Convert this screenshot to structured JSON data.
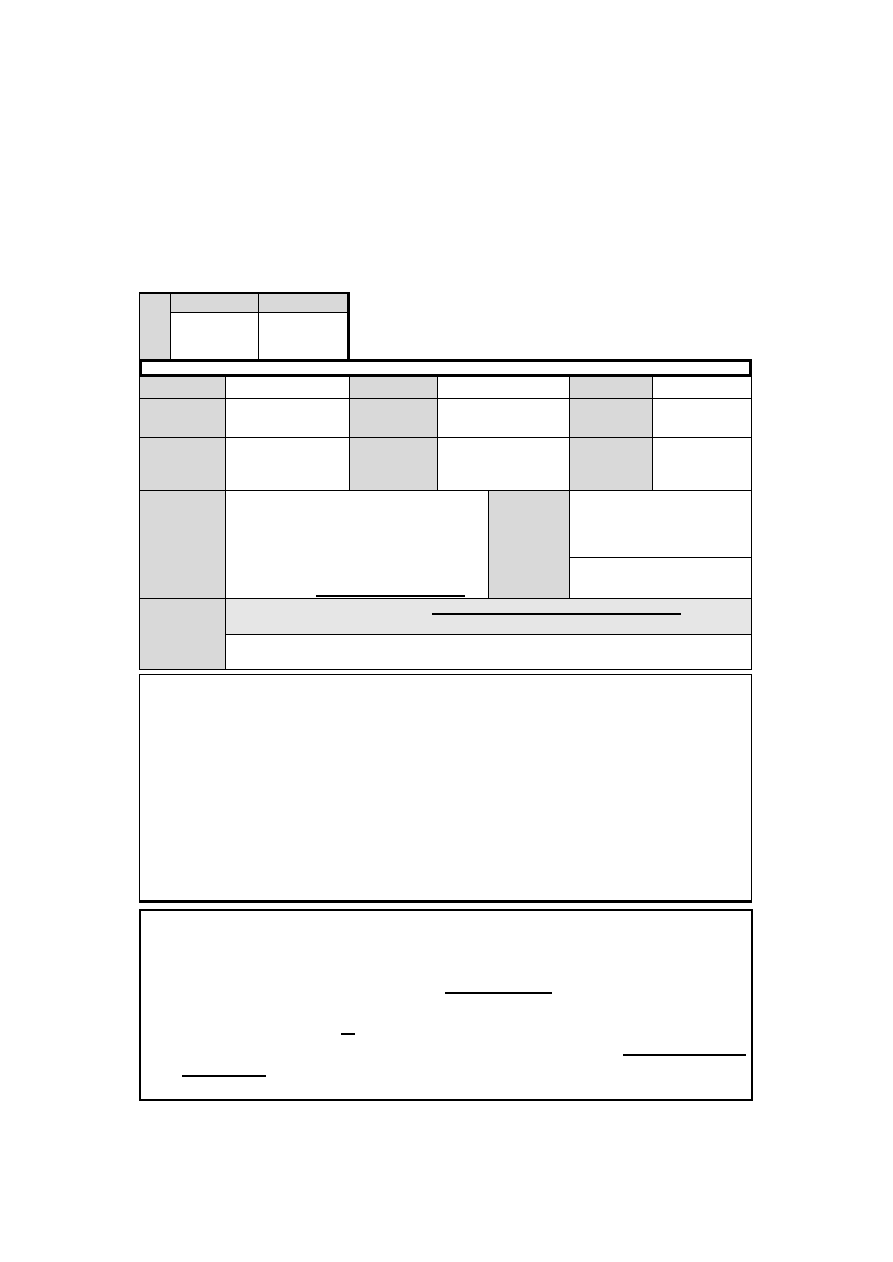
{
  "page": {
    "background": "#ffffff"
  },
  "colors": {
    "label_cell_shade": "#d9d9d9",
    "highlight_band_shade": "#e6e6e6",
    "border": "#000000",
    "page_background": "#ffffff"
  },
  "header_table": {
    "stub": "",
    "col_a_header": "",
    "col_b_header": "",
    "col_a_value": "",
    "col_b_value": ""
  },
  "title_bar": {
    "text": ""
  },
  "details_table": {
    "rows": [
      {
        "label1": "",
        "value1": "",
        "label2": "",
        "value2": "",
        "label3": "",
        "value3": ""
      },
      {
        "label1": "",
        "value1": "",
        "label2": "",
        "value2": "",
        "label3": "",
        "value3": ""
      },
      {
        "label1": "",
        "value1": "",
        "label2": "",
        "value2": "",
        "label3": "",
        "value3": ""
      }
    ],
    "row4": {
      "label": "",
      "main_value": "",
      "mid_label": "",
      "right_top_value": "",
      "right_bottom_value": ""
    },
    "row5": {
      "label": "",
      "band_value": "",
      "bottom_value": ""
    }
  },
  "notes_box": {
    "content": ""
  },
  "signature_box": {
    "content": "",
    "blanks": [
      "",
      "",
      "",
      ""
    ]
  }
}
